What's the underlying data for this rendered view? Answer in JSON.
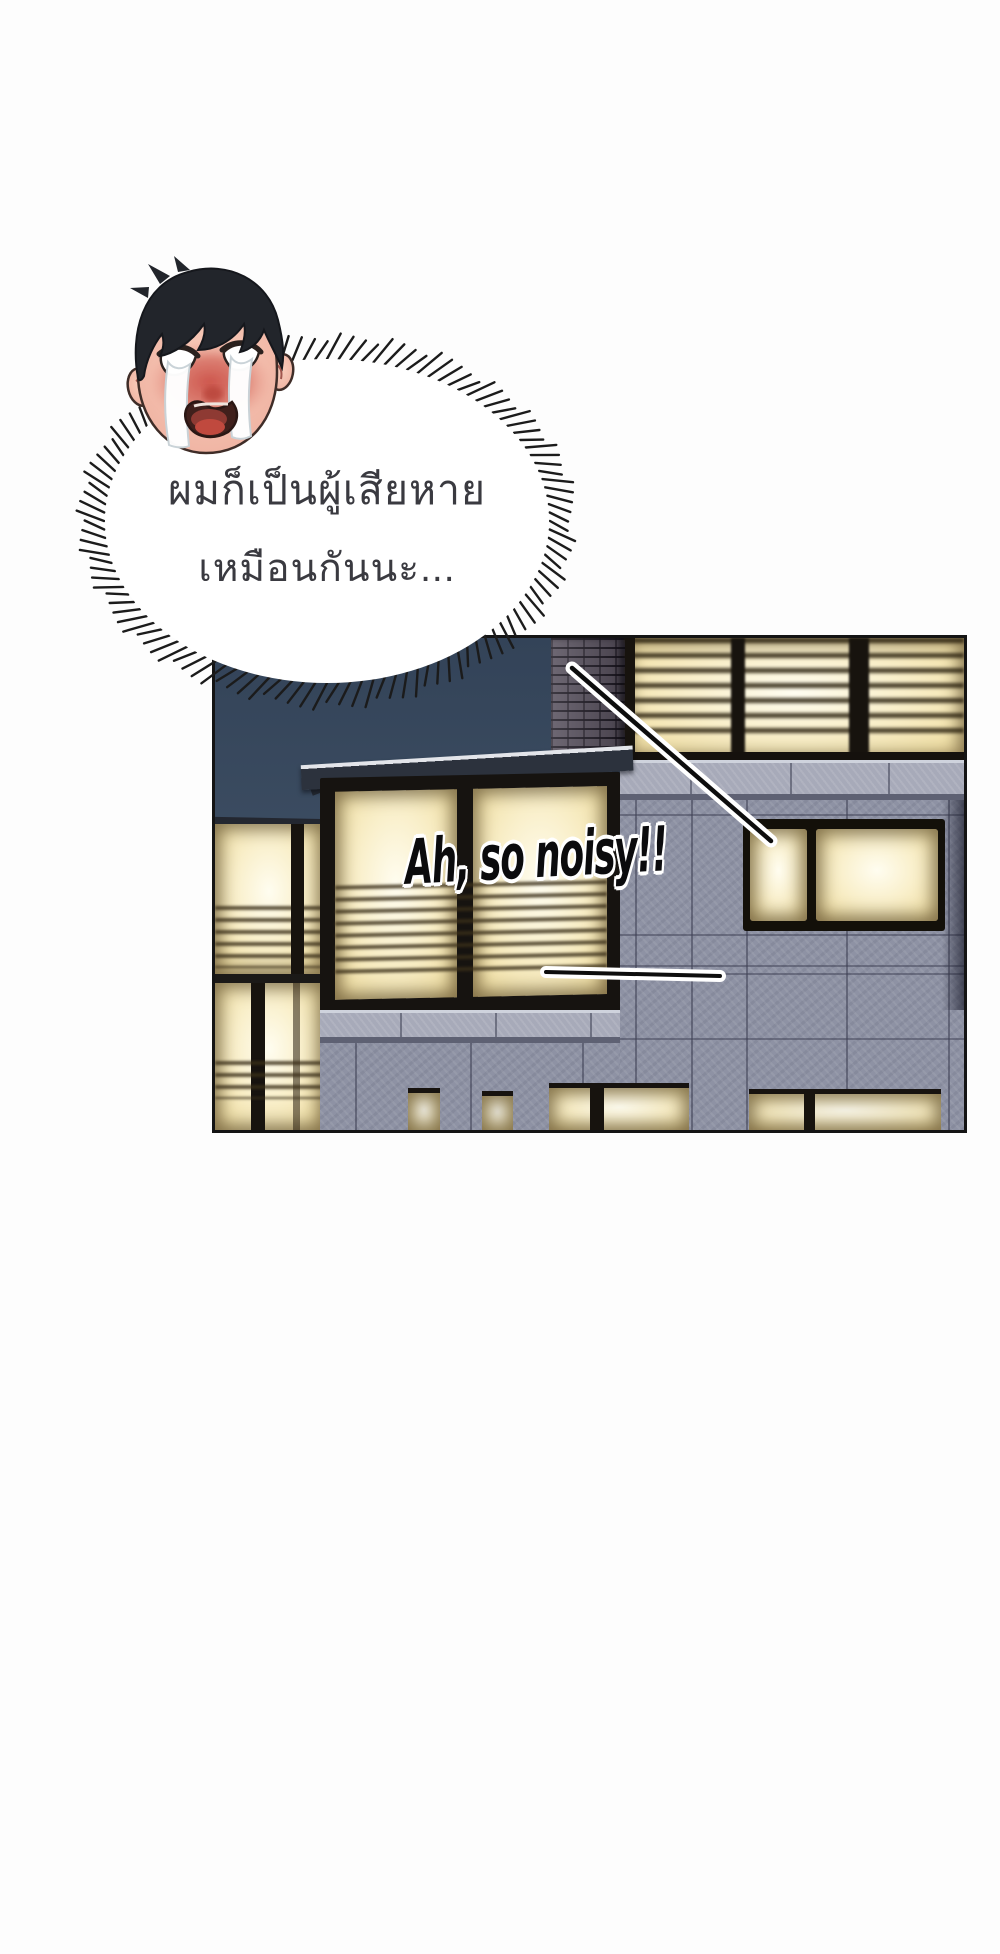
{
  "page": {
    "background": "#fdfdfd"
  },
  "bubble": {
    "dialogue_line1": "ผมก็เป็นผู้เสียหาย",
    "dialogue_line2": "เหมือนกันนะ...",
    "fill_color": "#ffffff",
    "spike_color": "#1b1b1b",
    "text_color": "#3a3a40"
  },
  "character": {
    "description": "crying man head with tear streams and heavy blush",
    "hair_color": "#22252b",
    "skin_color": "#f2bcab",
    "blush_color": "#cc5148",
    "tear_color": "#ffffff"
  },
  "panel": {
    "caption": {
      "text": "Ah, so noisy!!",
      "color": "#0b0b0d",
      "outline_color": "#ffffff"
    },
    "scene": "night building facade with lit windows",
    "colors": {
      "border": "#141414",
      "sky_top": "#334358",
      "sky_bottom": "#4a5b6e",
      "window_glow": "#f9efca",
      "window_bright": "#fffdf0",
      "blind_shadow": "#4a3c22",
      "wall_stone": "#8e92a4",
      "wall_seam": "#5c5f72",
      "ledge": "#a7aab9",
      "brick": "#5a5360",
      "frame_dark": "#161310",
      "pointer_line": "#0d0d0d",
      "pointer_outline": "#ffffff"
    }
  }
}
